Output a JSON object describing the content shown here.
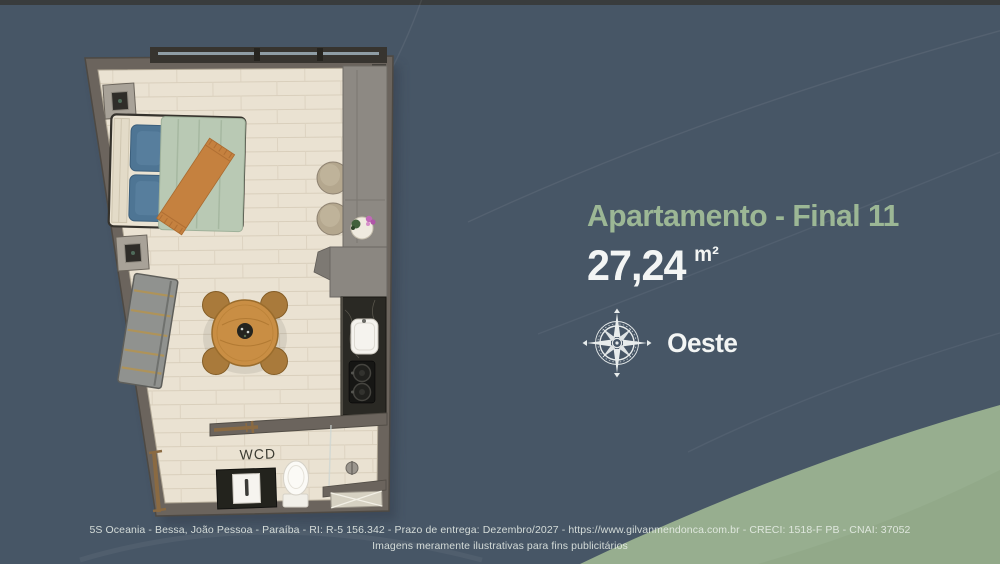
{
  "header": {
    "title": "Apartamento - Final 11",
    "area_value": "27,24",
    "area_unit": "m²",
    "orientation": "Oeste"
  },
  "floorplan": {
    "bathroom_label": "WCD"
  },
  "footer": {
    "line1": "5S Oceania - Bessa, João Pessoa - Paraíba - RI: R-5 156.342 - Prazo de entrega: Dezembro/2027 - https://www.gilvanmendonca.com.br - CRECI: 1518-F PB - CNAI: 37052",
    "line2": "Imagens meramente ilustrativas para fins publicitários"
  },
  "colors": {
    "background_slate": "#475666",
    "top_strip": "#393c3d",
    "wave_green": "#97ae8f",
    "wave_green_dark": "#8ea685",
    "title_green": "#9cb795",
    "text_white": "#f3f5f4",
    "wall_gray": "#6b645d",
    "floor_wood": "#eae2d2"
  }
}
